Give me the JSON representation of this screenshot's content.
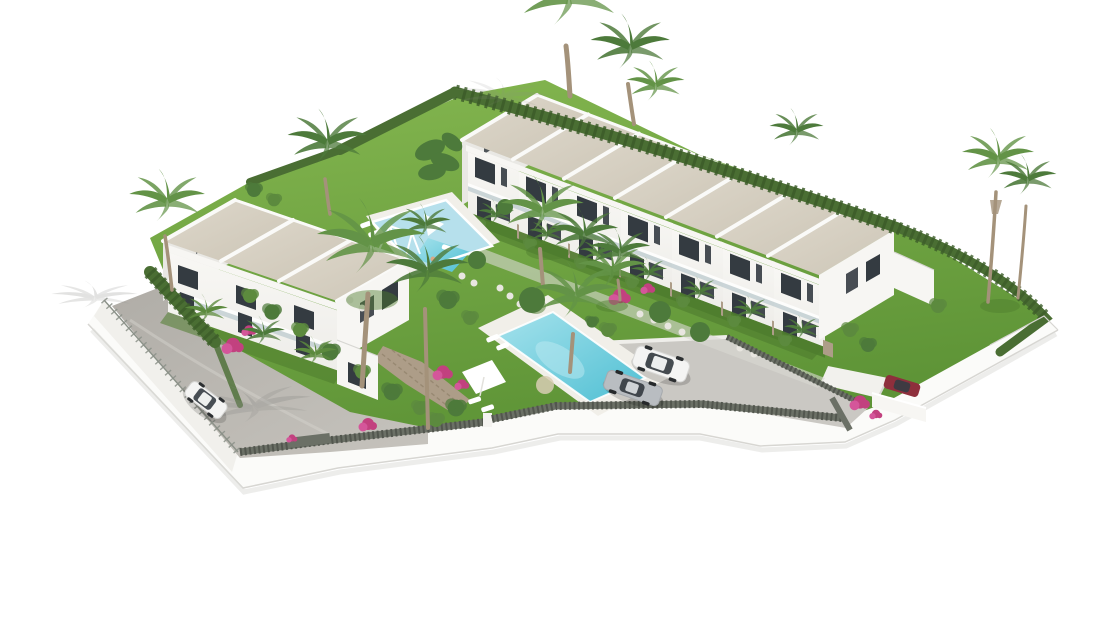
{
  "meta": {
    "title": "New-build residential complex — aerial 3D render",
    "description": "Aerial 3D architectural rendering of a white Mediterranean residential complex: a row of seven terraced townhouses with beige roofs, a three-unit villa block, a children's playground pool, a large turquoise swimming pool with sun loungers and a shade sail, palm trees, cypress hedges, bougainvillea, a gravel driveway with a parked white hatchback, a parking area with a silver sedan and a white SUV, a red car at the entrance, all enclosed by a curving white perimeter wall with dark slatted fencing, on a plain white background."
  },
  "colors": {
    "wall_white": "#f7f6f3",
    "wall_shade": "#e9e8e4",
    "wall_dark": "#dddcd7",
    "parapet": "#fafaf8",
    "window_dark": "#343b41",
    "glass": "#a9bec5",
    "roof_light": "#ded8cb",
    "roof_dark": "#ccc5b6",
    "facade_light": "#f8f7f4",
    "facade_dark": "#eeede9",
    "lawn_light": "#85b750",
    "lawn_dark": "#5d9336",
    "lawn_shade": "#4e7c2e",
    "hedge": "#4a6e33",
    "hedge_dark": "#3c5c29",
    "bush": "#5c8a3e",
    "palm": "#639347",
    "palm_dark": "#4d7a3b",
    "trunk": "#a4927a",
    "pool_light": "#a5e2ec",
    "pool_dark": "#4fbfd3",
    "play_floor": "#b6e0ec",
    "pool_deck": "#f1efe9",
    "sand": "#d8cdb4",
    "gravel_light": "#c6c3bd",
    "gravel_dark": "#b0ada7",
    "paving": "#cac8c3",
    "stone": "#ad9d88",
    "fence_dark": "#6b7066",
    "fence_dark2": "#52564e",
    "wire": "#8b9188",
    "shadow": "#8d8d89",
    "bougainvillea": "#c2417f",
    "bougainvillea_light": "#d4569a",
    "car_white": "#f4f4f3",
    "car_silver": "#b9bdc1",
    "car_red": "#8e2f3c",
    "car_glass": "#353c42"
  },
  "scene": {
    "townhouse_row_units": 7,
    "villa_block_units": 3,
    "pools": [
      "children-playground-pool",
      "main-swimming-pool"
    ],
    "vehicles": [
      "white-hatchback",
      "silver-sedan",
      "white-suv",
      "red-car"
    ],
    "landscape": [
      "palm-trees",
      "cypress-hedges",
      "bougainvillea",
      "lawns",
      "banana-plants"
    ],
    "amenities": [
      "sun-loungers",
      "shade-sail",
      "swing-set",
      "stepping-stone-paths",
      "parking-area",
      "gravel-driveway",
      "perimeter-wall",
      "slatted-fence"
    ]
  }
}
